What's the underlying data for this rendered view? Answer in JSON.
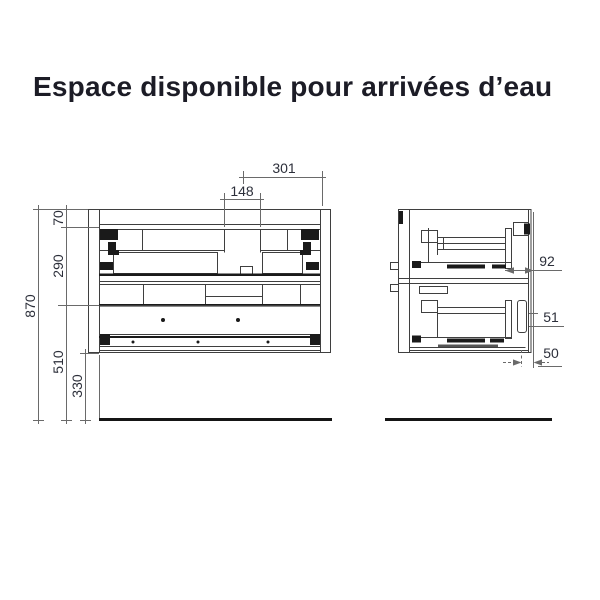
{
  "title": "Espace disponible pour arrivées d’eau",
  "front_view": {
    "dimensions": {
      "total_height": "870",
      "top_band": "70",
      "upper_zone": "290",
      "lower_zone": "510",
      "floor_clearance": "330",
      "inlet_axis_to_side": "301",
      "inlet_width": "148"
    }
  },
  "side_view": {
    "dimensions": {
      "space_behind_drawer": "92",
      "mid_clearance": "51",
      "bottom_clearance": "50"
    }
  },
  "colors": {
    "drawing_line": "#3f3f3f",
    "dimension_line": "#6a6a6a",
    "dim_text": "#2c2f3a",
    "title_text": "#1c1c26",
    "solid_fill": "#1a1a1a",
    "floor": "#151515"
  }
}
